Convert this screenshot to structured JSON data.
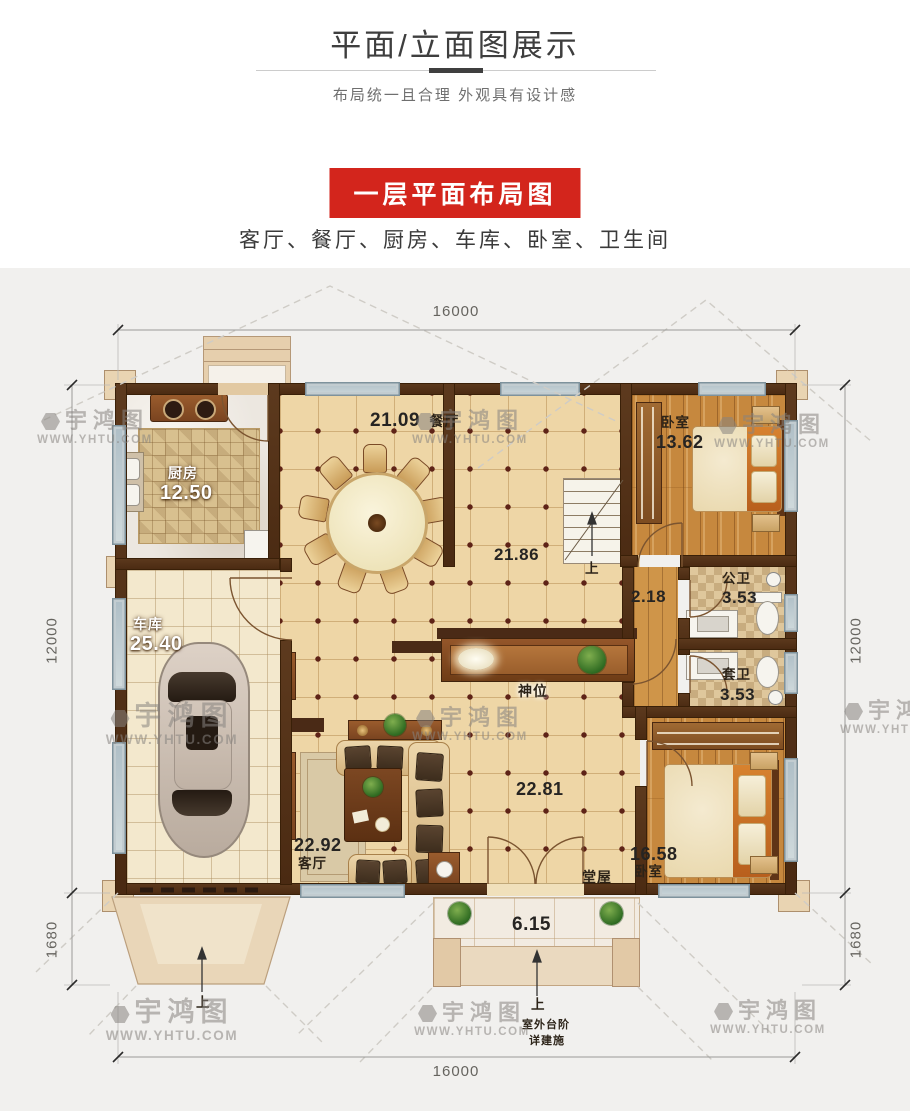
{
  "header": {
    "title": "平面/立面图展示",
    "subtitle": "布局统一且合理  外观具有设计感"
  },
  "banner": {
    "label": "一层平面布局图"
  },
  "intro": {
    "rooms_line": "客厅、餐厅、厨房、车库、卧室、卫生间"
  },
  "watermark": {
    "brand": "宇鸿图",
    "url": "WWW.YHTU.COM"
  },
  "colors": {
    "accent_red": "#d3251c",
    "wall_brown": "#553218",
    "floor_tile": "#eed6a6",
    "floor_wood": "#c6883e"
  },
  "plan": {
    "dimensions": {
      "top": "16000",
      "bottom": "16000",
      "left_main": "12000",
      "left_lower": "1680",
      "right_main": "12000",
      "right_lower": "1680"
    },
    "rooms": {
      "kitchen": {
        "name": "厨房",
        "area": "12.50"
      },
      "dining": {
        "area": "21.09",
        "name": "餐厅"
      },
      "bedroom_top": {
        "name": "卧室",
        "area": "13.62"
      },
      "hall_upper": {
        "area": "21.86"
      },
      "stairs": {
        "up": "上"
      },
      "corridor": {
        "area": "2.18"
      },
      "bath_public": {
        "name": "公卫",
        "area": "3.53"
      },
      "bath_suite": {
        "name": "套卫",
        "area": "3.53"
      },
      "garage": {
        "name": "车库",
        "area": "25.40"
      },
      "shrine": {
        "name": "神位"
      },
      "living": {
        "area": "22.92",
        "name": "客厅"
      },
      "hall_lower": {
        "area": "22.81"
      },
      "bedroom_bottom": {
        "area": "16.58",
        "name": "卧室"
      },
      "main_hall": {
        "name": "堂屋"
      },
      "porch": {
        "area": "6.15",
        "up": "上"
      },
      "ramp": {
        "up": "上"
      },
      "steps_note": {
        "line1": "室外台阶",
        "line2": "详建施"
      }
    }
  }
}
